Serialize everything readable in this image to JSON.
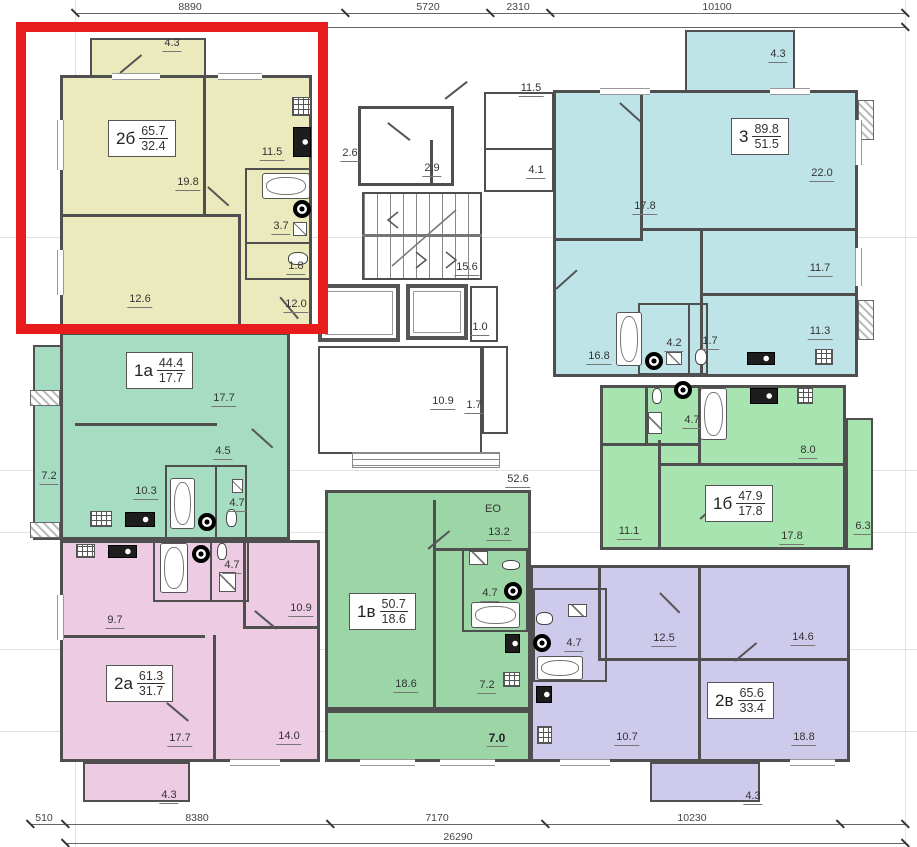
{
  "title": "residential floor plan",
  "colors": {
    "apt2b": "#eaeabd",
    "apt3": "#bfe4e8",
    "apt1a": "#a5dcc2",
    "apt1b": "#a8e4b0",
    "apt1v": "#9dd6a6",
    "apt2a": "#eccbe3",
    "apt2v": "#cecaec",
    "wall": "#4f4f4f",
    "highlight": "#e81c1c"
  },
  "dims": {
    "top": [
      "8890",
      "5720",
      "2310",
      "10100"
    ],
    "bottom": [
      "510",
      "8380",
      "7170",
      "10230"
    ],
    "total": "26290"
  },
  "apartments": {
    "a2b": {
      "type": "2б",
      "total": "65.7",
      "living": "32.4",
      "rooms": {
        "balcony": "4.3",
        "living": "19.8",
        "kitchen": "11.5",
        "bath": "3.7",
        "wc": "1.8",
        "bedroom": "12.6",
        "room": "12.0"
      }
    },
    "a3": {
      "type": "3",
      "total": "89.8",
      "living": "51.5",
      "rooms": {
        "balcony": "4.3",
        "bedroom1": "17.8",
        "living": "22.0",
        "bedroom2": "11.7",
        "kitchen": "11.3",
        "hall": "16.8",
        "bath": "4.2",
        "wc": "1.7"
      }
    },
    "a1a": {
      "type": "1а",
      "total": "44.4",
      "living": "17.7",
      "rooms": {
        "living": "17.7",
        "hall": "4.5",
        "balcony": "7.2",
        "kitchen": "10.3",
        "bath": "4.7"
      }
    },
    "a1b": {
      "type": "1б",
      "total": "47.9",
      "living": "17.8",
      "rooms": {
        "bath": "4.7",
        "kitchen": "8.0",
        "hall": "11.1",
        "living": "17.8",
        "balcony": "6.3"
      }
    },
    "a1v": {
      "type": "1в",
      "total": "50.7",
      "living": "18.6",
      "rooms": {
        "kitchen": "13.2",
        "bath": "4.7",
        "living": "18.6",
        "hall": "7.2",
        "loggia": "7.0",
        "eo": "ЕО"
      }
    },
    "a2a": {
      "type": "2а",
      "total": "61.3",
      "living": "31.7",
      "rooms": {
        "kitchen": "9.7",
        "bath": "4.7",
        "bedroom": "10.9",
        "living": "17.7",
        "room": "14.0",
        "balcony": "4.3"
      }
    },
    "a2v": {
      "type": "2в",
      "total": "65.6",
      "living": "33.4",
      "rooms": {
        "bedroom": "12.5",
        "room": "14.6",
        "bath": "4.7",
        "kitchen": "10.7",
        "living": "18.8",
        "balcony": "4.3"
      }
    }
  },
  "common": {
    "corridor_top": "11.5",
    "corridor": "4.1",
    "vestibule_a": "2.6",
    "vestibule_b": "2.9",
    "stair_hall": "15.6",
    "shaft": "1.0",
    "lobby": "10.9",
    "lobby_small": "1.7",
    "floor_corridor": "52.6"
  }
}
